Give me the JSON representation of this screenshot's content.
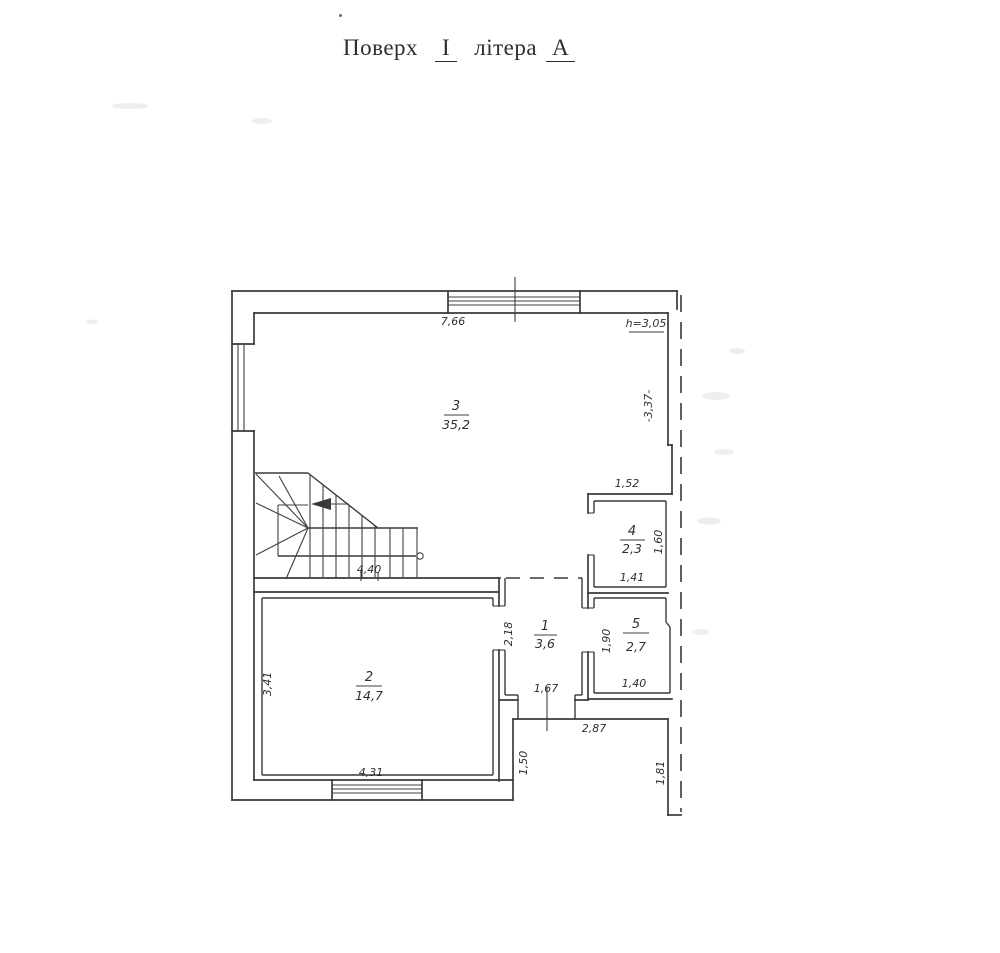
{
  "title": {
    "word1": "Поверх",
    "floor_numeral": "І",
    "word2": "літера",
    "building_letter": "А"
  },
  "plan": {
    "height_note": "h=3,05",
    "rooms": [
      {
        "number": "1",
        "area": "3,6"
      },
      {
        "number": "2",
        "area": "14,7"
      },
      {
        "number": "3",
        "area": "35,2"
      },
      {
        "number": "4",
        "area": "2,3"
      },
      {
        "number": "5",
        "area": "2,7"
      }
    ],
    "dims": {
      "top": "7,66",
      "right": "-3,37-",
      "stair": "4,40",
      "r4_top": "1,52",
      "r4_side": "1,60",
      "r4_bottom": "1,41",
      "r5_side": "1,90",
      "r5_bottom": "1,40",
      "r1_side": "2,18",
      "r1_bottom": "1,67",
      "r2_side": "3,41",
      "r2_bottom": "4,31",
      "porch_top": "2,87",
      "porch_left": "1,50",
      "porch_right": "1,81"
    }
  },
  "colors": {
    "ink": "#3a3a3a",
    "paper": "#ffffff"
  }
}
